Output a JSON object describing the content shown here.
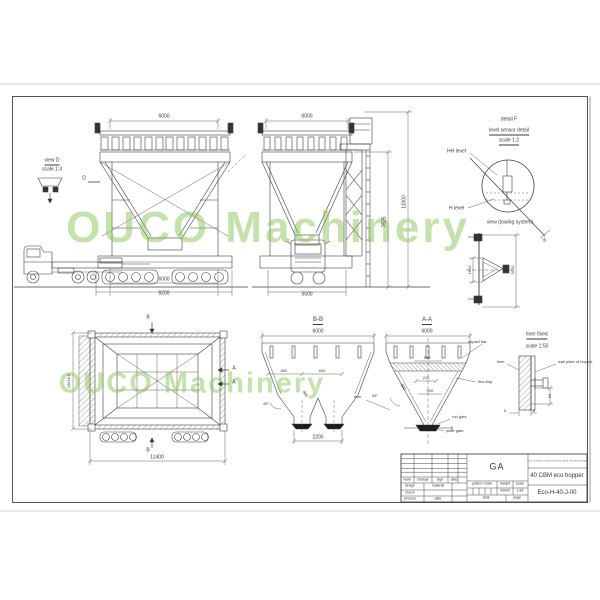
{
  "watermark": {
    "text": "OUCO Machinery"
  },
  "front_view": {
    "dim_top": "6000",
    "dim_bottom_inner": "6000",
    "dim_bottom_outer": "8200",
    "view_d_label": "view D",
    "view_d_scale": "scale 1:4",
    "section_marker": "D"
  },
  "side_view": {
    "dim_top": "6000",
    "dim_bottom": "5500",
    "dim_height_inner": "7625",
    "dim_height_outer": "11000"
  },
  "detail_f": {
    "title": "detail F",
    "subtitle": "level sensor detail",
    "scale": "scale 1:2",
    "hh_level": "HH level",
    "h_level": "H level",
    "angle": "20"
  },
  "towing_view": {
    "title": "view (towing system)",
    "dim_inner": "1600",
    "dim_outer": "3500"
  },
  "top_view": {
    "marker_b": "B",
    "marker_a": "A",
    "dim_width": "11400",
    "dim_height": "10618.5"
  },
  "section_bb": {
    "title": "B-B",
    "dim_top": "6000",
    "dim_800": "800",
    "dim_600": "600",
    "dim_slope": "800",
    "angle": "45°",
    "dim_bottom": "2200",
    "liner_label": "liner"
  },
  "section_aa": {
    "title": "A-A",
    "dim_top": "6000",
    "impact_bar": "impact bar",
    "dim_500": "500",
    "dim_212": "212",
    "dim_900": "900",
    "dim_slope": "800",
    "angle": "55°",
    "flap_label": "flex-flap",
    "rod_gate": "rod gate",
    "plate_gate": "plate gate"
  },
  "liner_detail": {
    "title": "liner fixed",
    "scale": "scale 1:50",
    "liner": "liner",
    "wall_plate": "wall plate of hopper",
    "dim_50": "50",
    "dim_5": "5",
    "dim_8": "8"
  },
  "title_block": {
    "ga": "GA",
    "company": "eco heavy machinery and technology",
    "product": "40 CBM eco hopper",
    "drawing_no": "Eco-H-40-J-00",
    "col_mark": "mark",
    "col_change": "change",
    "col_sign": "sign",
    "col_date": "date",
    "row_design": "design",
    "row_material": "material",
    "row_check": "check",
    "row_process": "process",
    "row_date": "date",
    "pattern_mark": "pattern mark",
    "weight": "weight",
    "scale": "scale",
    "weight_value": "40000",
    "scale_value": "1:85",
    "total": "total",
    "page": "page"
  }
}
